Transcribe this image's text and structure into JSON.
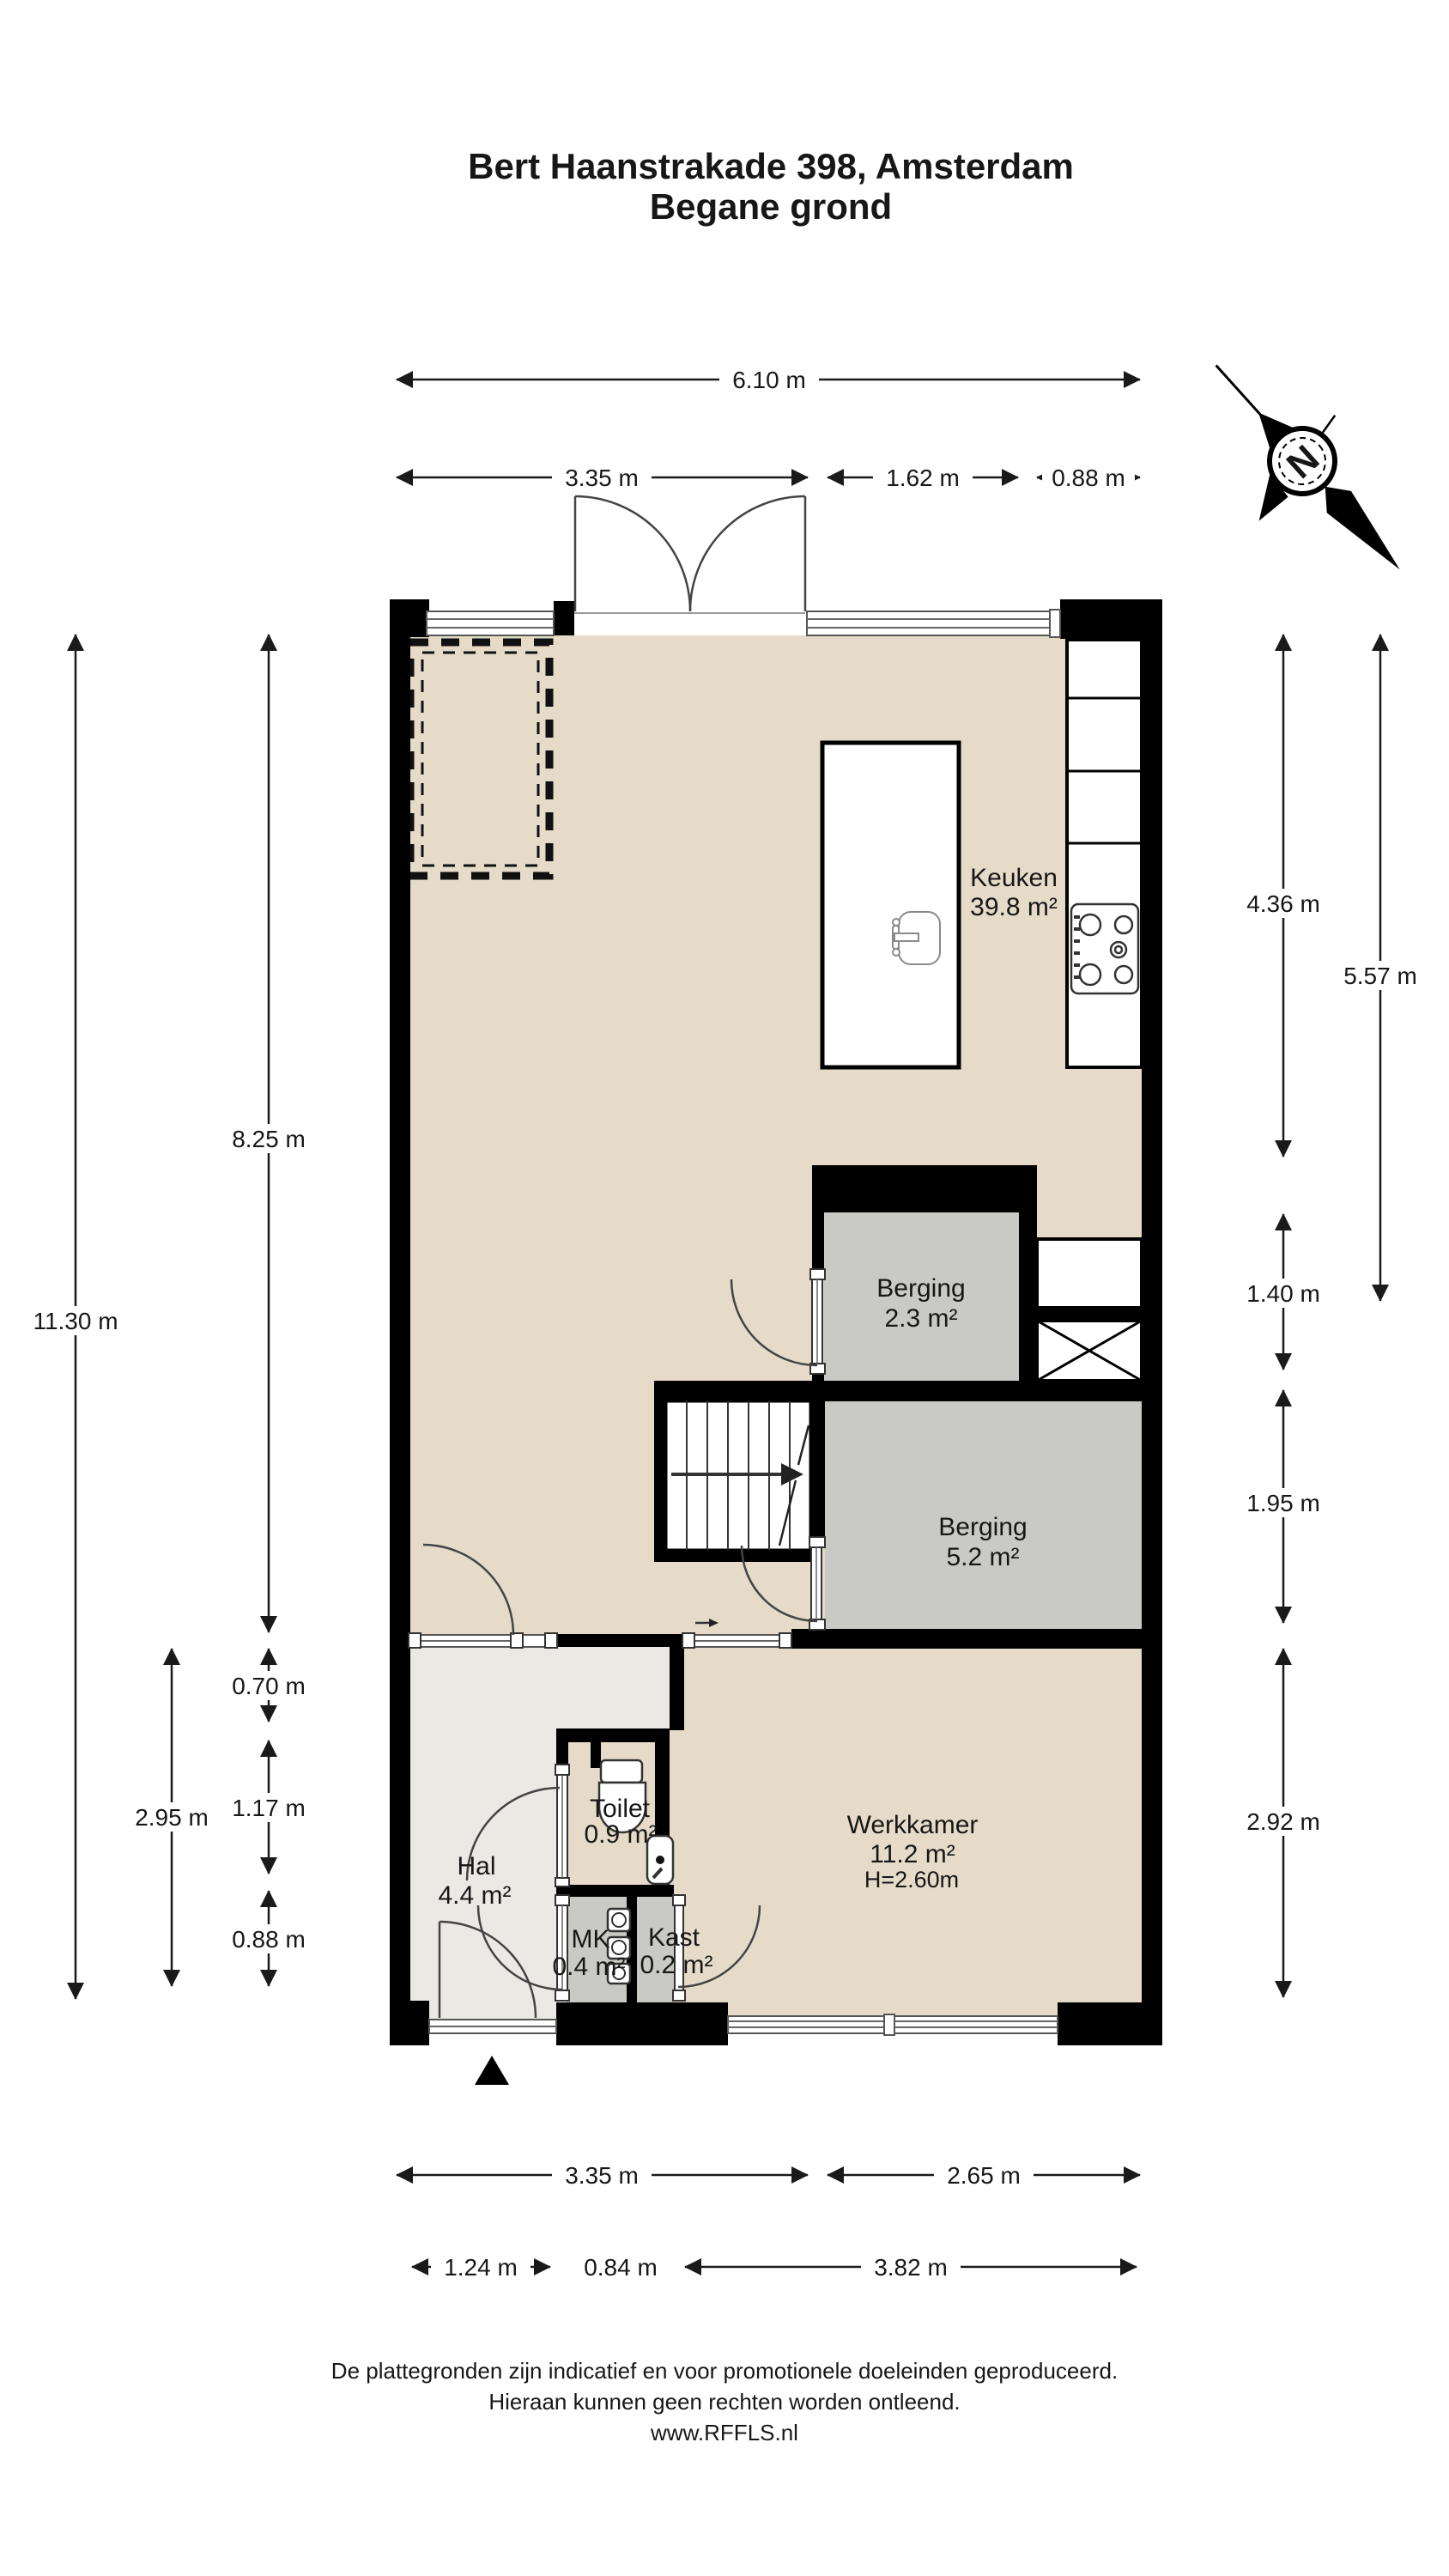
{
  "title": {
    "line1": "Bert Haanstrakade 398, Amsterdam",
    "line2": "Begane grond"
  },
  "rooms": {
    "keuken": {
      "name": "Keuken",
      "area": "39.8 m²"
    },
    "berging_klein": {
      "name": "Berging",
      "area": "2.3 m²"
    },
    "berging_groot": {
      "name": "Berging",
      "area": "5.2 m²"
    },
    "werkkamer": {
      "name": "Werkkamer",
      "area": "11.2 m²",
      "height": "H=2.60m"
    },
    "hal": {
      "name": "Hal",
      "area": "4.4 m²"
    },
    "toilet": {
      "name": "Toilet",
      "area": "0.9 m²"
    },
    "mk": {
      "name": "MK",
      "area": "0.4 m²"
    },
    "kast": {
      "name": "Kast",
      "area": "0.2 m²"
    }
  },
  "dimensions": {
    "top": {
      "total": "6.10 m",
      "segments": [
        "3.35 m",
        "1.62 m",
        "0.88 m"
      ]
    },
    "left": {
      "total": "11.30 m",
      "inner": [
        "8.25 m",
        "0.70 m",
        "1.17 m",
        "0.88 m"
      ],
      "outer_bottom": "2.95 m"
    },
    "right": {
      "outer": "5.57 m",
      "inner": [
        "4.36 m",
        "1.40 m",
        "1.95 m",
        "2.92 m"
      ]
    },
    "bottom": {
      "row1": [
        "3.35 m",
        "2.65 m"
      ],
      "row2": [
        "1.24 m",
        "0.84 m",
        "3.82 m"
      ]
    }
  },
  "compass": {
    "label": "N"
  },
  "footer": {
    "line1": "De plattegronden zijn indicatief en voor promotionele doeleinden geproduceerd.",
    "line2": "Hieraan kunnen geen rechten worden ontleend.",
    "line3": "www.RFFLS.nl"
  },
  "colors": {
    "floor_main": "#e5dbc8",
    "floor_storage": "#c9c9c5",
    "floor_hall": "#ebe9e4",
    "wall": "#000000",
    "dim_text": "#1a1a1a"
  }
}
